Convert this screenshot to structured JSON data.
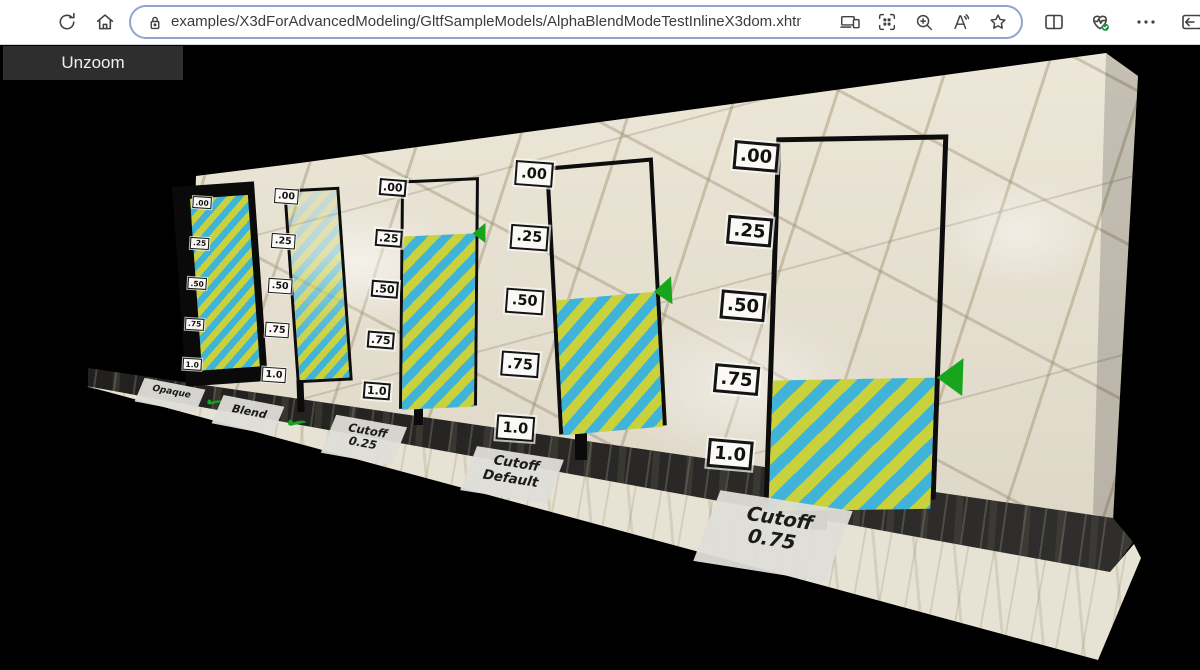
{
  "browser": {
    "url": "examples/X3dForAdvancedModeling/GltfSampleModels/AlphaBlendModeTestInlineX3dom.xhtml",
    "toolbar_icons": [
      "refresh",
      "home"
    ],
    "omnibox_icons": [
      "site-info-lock",
      "send-to-devices",
      "apps-grid",
      "zoom-in",
      "read-aloud",
      "favorite-star"
    ],
    "right_icons": [
      "split-screen",
      "browser-essentials",
      "more-options",
      "sidebar-toggle"
    ]
  },
  "viewer": {
    "unzoom_label": "Unzoom",
    "scale_ticks": [
      ".00",
      ".25",
      ".50",
      ".75",
      "1.0"
    ],
    "check_glyph": "✔",
    "panels": [
      {
        "label_line1": "Opaque",
        "label_line2": "",
        "checked": true,
        "fill_start": 0.0,
        "arrow": false
      },
      {
        "label_line1": "Blend",
        "label_line2": "",
        "checked": true,
        "fill_start": 0.0,
        "arrow": false
      },
      {
        "label_line1": "Cutoff",
        "label_line2": "0.25",
        "checked": false,
        "fill_start": 0.25,
        "arrow": true
      },
      {
        "label_line1": "Cutoff",
        "label_line2": "Default",
        "checked": false,
        "fill_start": 0.5,
        "arrow": true
      },
      {
        "label_line1": "Cutoff",
        "label_line2": "0.75",
        "checked": false,
        "fill_start": 0.75,
        "arrow": true
      }
    ],
    "colors": {
      "stripe_yellow": "#c9d23c",
      "stripe_blue": "#3fb4d8",
      "arrow_green": "#17a51d",
      "marble_base": "#eae3d2",
      "canvas_background": "#000000"
    }
  }
}
